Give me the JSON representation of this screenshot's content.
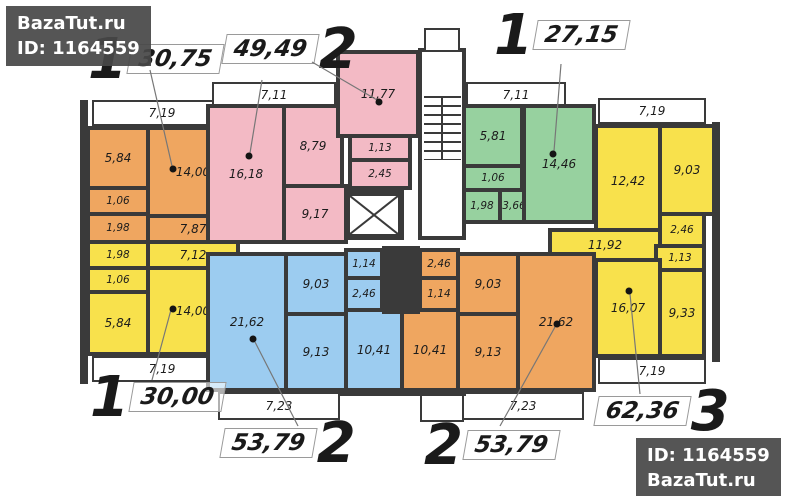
{
  "watermark_top_left": {
    "line1": "BazaTut.ru",
    "line2": "ID: 1164559"
  },
  "watermark_bottom_right": {
    "line1": "ID: 1164559",
    "line2": "BazaTut.ru"
  },
  "apartments": {
    "a1_top_left_orange": {
      "digit": "1",
      "total": "30,75",
      "balcony": "7,19",
      "kitchen": "5,84",
      "wc": "1,06",
      "bath": "1,98",
      "living": "14,00",
      "hall": "7,87"
    },
    "a2_top_mid_pink": {
      "digit": "2",
      "total": "49,49",
      "balcony": "7,11",
      "living": "16,18",
      "kitchen": "8,79",
      "hall": "9,17",
      "bedroom": "11,77",
      "wc": "1,13",
      "bath": "2,45"
    },
    "a3_top_right_green": {
      "digit": "1",
      "total": "27,15",
      "balcony": "7,11",
      "kitchen": "5,81",
      "wc": "1,06",
      "bath": "1,98",
      "hall": "3,66",
      "living": "14,46"
    },
    "a4_right_yellow": {
      "digit": "3",
      "total": "62,36",
      "balcony_top": "7,19",
      "bedroom1": "12,42",
      "bedroom2": "9,03",
      "storage": "2,46",
      "hall": "11,92",
      "wc": "1,13",
      "living": "16,07",
      "kitchen": "9,33",
      "balcony_bottom": "7,19"
    },
    "a5_bottom_left_yellow": {
      "digit": "1",
      "total": "30,00",
      "bath": "1,98",
      "hall": "7,12",
      "wc": "1,06",
      "kitchen": "5,84",
      "living": "14,00",
      "balcony": "7,19"
    },
    "a6_bottom_mid_blue": {
      "digit": "2",
      "total": "53,79",
      "living": "21,62",
      "hall": "9,03",
      "wc": "1,14",
      "bath": "2,46",
      "kitchen": "9,13",
      "bedroom": "10,41",
      "balcony": "7,23"
    },
    "a7_bottom_mid_orange": {
      "digit": "2",
      "total": "53,79",
      "bath": "2,46",
      "wc": "1,14",
      "bedroom": "10,41",
      "hall": "9,03",
      "kitchen": "9,13",
      "living": "21,62",
      "balcony": "7,23"
    }
  },
  "colors": {
    "wall": "#3a3a3a",
    "orange": "#efa660",
    "pink": "#f3bac5",
    "green": "#97d19f",
    "yellow": "#f8e14c",
    "blue": "#9cccf0",
    "watermark_bg": "#4b4b4b"
  }
}
